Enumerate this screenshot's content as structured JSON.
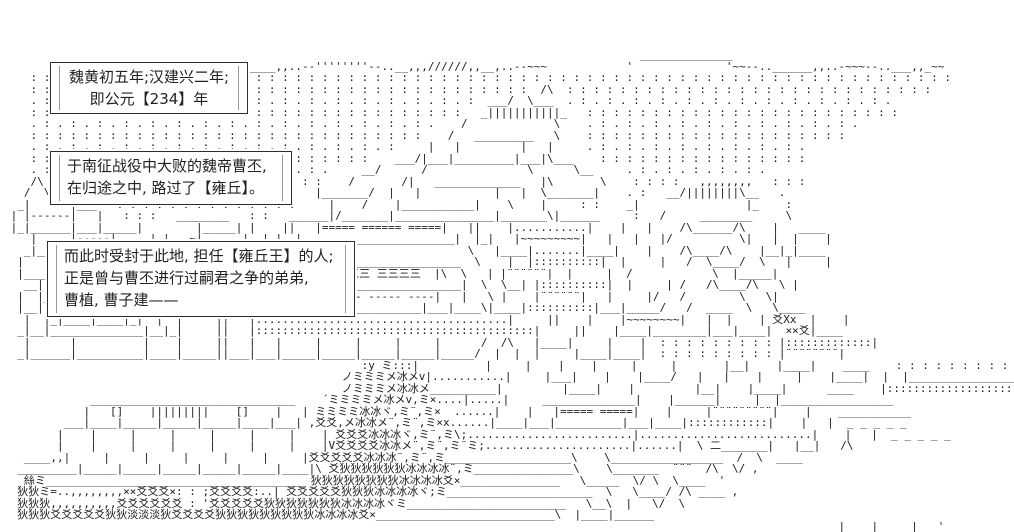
{
  "scene": {
    "background_color": "#ffffff",
    "art_color": "#1c1c1c",
    "box_border_color": "#2e2e2e"
  },
  "dialog_boxes": [
    {
      "lines": [
        "魏黄初五年;汉建兴二年;",
        "即公元【234】年"
      ]
    },
    {
      "lines": [
        "于南征战役中大败的魏帝曹丕,",
        "在归途之中, 路过了【雍丘】。"
      ]
    },
    {
      "lines": [
        "而此时受封于此地, 担任【雍丘王】的人;",
        "正是曾与曹丕进行过嗣君之争的弟弟,",
        "曹植, 曹子建——"
      ]
    }
  ],
  "ascii_art": {
    "lines": [
      "",
      "",
      "                                                                                                ______________",
      "       ,,,,        ____          ________,,..--''''''''--..__,,,//////,,__,..--~~~            '              '~~--..______,,..-~~~--..___,,_~~",
      "    : : : : : : : : : : : : : : : : : : : : : : : : : : : : : : : : : : : : : : : : : : : : : : : : : : : : : : : : : : : : : : : : : : : : : :",
      "    : : : : : : : : : : : : : : : : : : : : : : : : : : : : : : : : : : : : : :  /\\  : : : : : : : : : : : : : : : : : : : : : : : : : : : :",
      "    . : . : . : . : . : . : . : . : . : . : . : . : . : . : . : . : . :  ___/  \\___  . : . : . : . : . : . : . : . : . : . : . : . : .",
      "    : : : : : : : : : : : : : : : : : : : : : : : : : : : : : : : : :   _|||||||||||_   : : : : : : : : : : : : : : : : : : : : : : : :",
      "    . : . : . : . : . : . : . : . : . : . : . : . : . : . : . : .    /             \\    . : . : . : . : . : . : . : . : . : . : .",
      "    : : : : : : : : : : : : : : : : : : : : : : : : : : : : : :    /   _________   \\    : : : : : : : : : : : : : : : : : : : :",
      "    . : . : . : . : . : . : . : . : . : . : . : . : . : . :     |   |         |   |     . : . : . : . : . : . : . : . : .",
      "    : : : : : : : : : : : : : : : : : : : : : : : : : :    ___/|___|_________|___|\\___    : : : : : : : : : : : : : : : :",
      "    . : . : . : . : . : . : . : . : . : . : . : .     __/      /               \\      \\__     . : . : . : . : . : .",
      "    /\\   : : : : : : : : : : : : : : : : : : : :    /       /|   _____________   |\\       \\    : : : :   ,,,,,,,,   : : :",
      "   /  \\___   . : . : . : . : . : . : . : .     |_______/  |   |           |   |  \\_______|    . :   __/||||||||\\__   .",
      "  _|      |___   : : : : : : : : : : : : : :     |    /    |___________|    \\    |     : :    _|                |_    :",
      " | |------|   |   : : :   ________   : :   ______|/_______|_______________|_______\\|______     :   /     ________     \\",
      " |_|______|___|_____|        |_____| |    ||   |===== ====== =====|   ||    |...........|    |   |    /\\______/\\    |   ____",
      "    |     |-----|     |_|   ~|......|  |_|  |_______________________|  |_|   |~~~~~~~~~|   |   |   |/          \\|   |  |    |",
      "   _|_____|=====|_____|  |____|......|____|   /                       \\   |____|.......|____|    |    /\\____/\\    |__|_|____",
      "  |    |    |-----|    |    |  |   /  _______________________________  \\    |  |::::::::::|  |     |   /  \\____/  \\   |     |",
      "  |____|____|_____|____|    | |   /  /|  三三三三 三三三三 三三三三  |\\  \\   | |¨¨¨¨¨¨|  |     |  /            \\  |_____|",
      "   __|    |=====|    |__    | |__/  /  |_____________________________|  \\  \\__| |::::::::::|  |     | /   /\\____/\\   \\ |",
      "  |  |____|=====|____|  |   |   | /   |   |----- ----- ----- ----|   |   \\ |    |¨¨¨¨¨¨|   |     |/   /        \\   \\|",
      "  |__|  |    |    |  |__|  _|___|/____|___|____________________|___|____\\|____|::::::::::|___|_____/   /  ____  \\   \\____",
      "   |  |_|____|____|_|  |  |     ||   |......................................|     ||    |    |~~~~~~~~|   |  |    | 爻Xx  |    |",
      "  _|__|______________|__|_|     ||   |::::::::::::::::::::::::::::::::::::::::::|     ||    |____|________|___|____|  ××爻|____",
      "   |      |          |    |     ||   |   |     |     |     |     |      /  /\\   |____|     |    |  : : : : : : : : : |:::::::::::::|",
      "  _|______|__________|____|_____||___|___|_____|_____|_____|_____|_____/  |  |  |     |____|____|  : : : : : : : : : |¨¨¨¨¨¨¨¨|",
      "                                                      :y ミ:::|          |     |    |    |     |     |       |__|    |____|    ____    : : : : : : : : : :",
      "                                                   ノミミミメ冰メv|...........|     |___|    |    |____/   |   |    |     |    |____|  |  |______________________",
      "                                                   ノミミミメ冰冰メ__________|         |____|    |         |__|    |____|      ____    |:::::::::::::::::::::::::::::",
      "             _______________________________    ´ミミミミメ冰メv׾,ミ×....|.....|     ______________|    |______|     |  |_________________",
      "            |   []    |||||||||    []    |   | ミミミミ冰冰ヾ,ミ¨,ミ×  ......|    |   |===== =====|    |     |¨¨¨¨¨¨¨¨¨|    |    ___________",
      "         ___|____|_____|_____|_____|____|___| ,爻爻,メ冰冰メ¨,ミ¨,ミ×x......|____|___|__________|___|____|::::::::::::|    |   |  _ _ _ _ _",
      "        |    |     |     |     |     |     |    | 爻爻爻冰冰冰ヾ,ミ¨,ミ\\;.........................|..........................|    |   |  _ _ _ _ _",
      "        |    |     |     |     |     |     |    |V爻爻爻爻冰冰メ¨,ミ¨,ミ¨ミ;......................|......|  \\ 二_______|   |__|   /\\",
      "   ____,,|     |     |     |     |     |     |爻爻爻爻爻冰冰冰¨,ミ¨,ミ___________________\\    \\_________________  /  \\  ____",
      "  _________|_____|_____|_____|_____|_____|____|\\ 爻狄狄狄狄狄狄冰冰冰冰¨,ミ_______________\\    \\_______  ¨¨¨  /\\  \\/ ,",
      "   絲ミ_______________________________________ 狄狄狄狄狄狄狄狄冰冰冰冰爻×_______________   \\_____  \\/ \\  \\____  '",
      "  狄狄ミ=..,,,,,,,,××爻爻爻×: : ;爻爻爻爻:..| 爻爻爻爻爻狄狄狄冰冰冰冰ヾ;ミ______________________  \\   \\____/ /\\ ____ ,",
      "  狄狄狄,,,,,,,,,,爻爻爻爻爻爻 : '爻爻爻爻爻狄狄狄狄狄狄狄冰冰冰冰ヾミ________________________   \\__\\  |   \\/  \\",
      "  狄狄狄爻爻爻爻爻狄狄淡淡淡狄爻爻爻爻狄狄狄狄狄狄狄狄狄冰冰冰冰爻×___________________________\\  |____|______",
      "                                                                                                                            __|    |_____|   '",
      "                                                                                                                           |______________|  ,",
      "",
      ""
    ]
  }
}
